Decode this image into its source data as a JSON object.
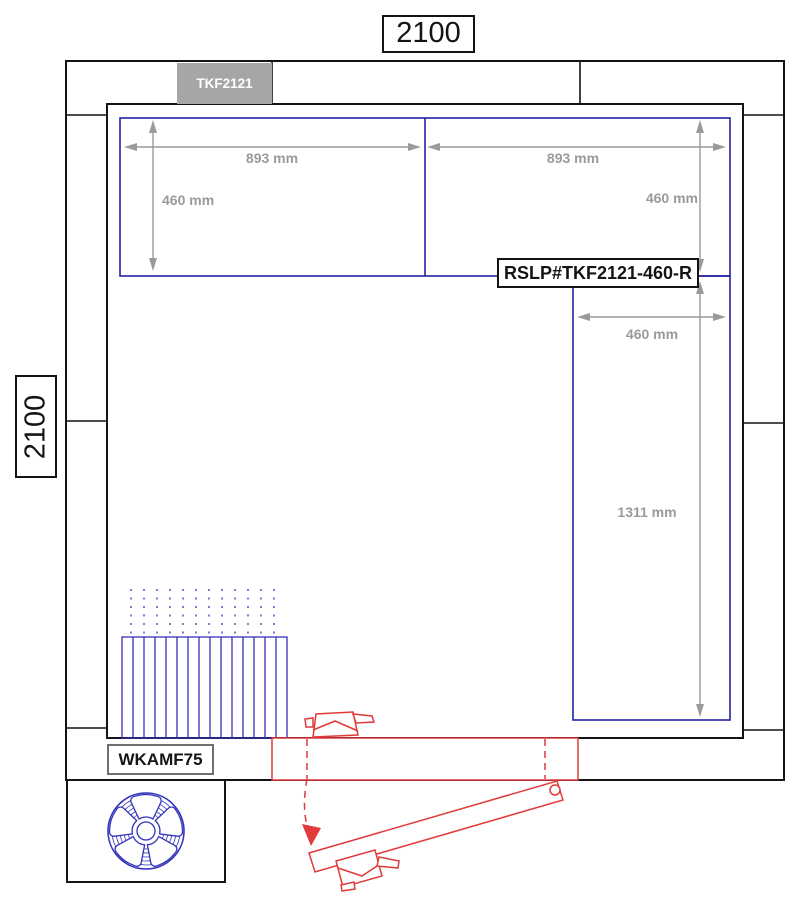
{
  "drawing": {
    "overall_width_label": "2100",
    "overall_height_label": "2100",
    "ceiling_panel_label": "TKF2121",
    "right_panel_code_label": "RSLP#TKF2121-460-R",
    "evaporator_model_label": "WKAMF75",
    "dimensions": {
      "top_left_panel_width": "893 mm",
      "top_right_panel_width": "893 mm",
      "top_left_panel_depth": "460 mm",
      "top_right_panel_depth": "460 mm",
      "right_strip_width": "460 mm",
      "right_strip_height": "1311 mm"
    },
    "colors": {
      "wall_black": "#141414",
      "panel_line_blue": "#2222a2",
      "equipment_blue": "#3333bb",
      "dimension_gray": "#9a9a9a",
      "door_red": "#e03a3a",
      "ceiling_panel_fill": "#a6a6a6"
    },
    "icons": {
      "fan_icon": "evaporator fan with 5 blades (blue outline)",
      "evaporator_fins": "finned cooler block with dotted airflow",
      "door_swing": "red hinged door shown closed and open with swing arc"
    }
  }
}
